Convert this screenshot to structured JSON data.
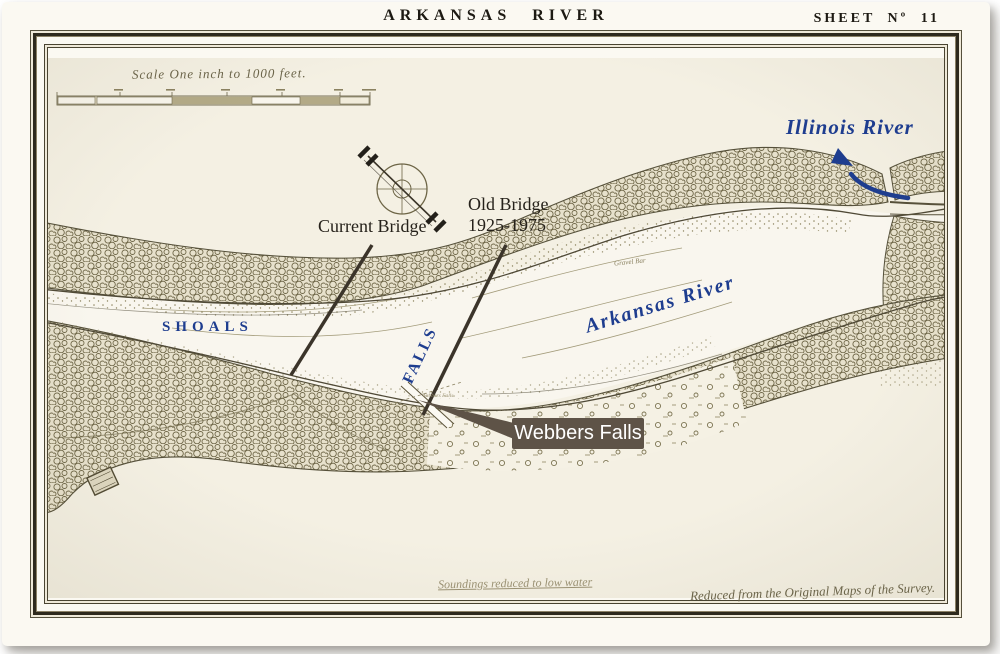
{
  "header": {
    "title": "ARKANSAS RIVER",
    "sheet_no": "SHEET Nº 11"
  },
  "scale": {
    "caption": "Scale One inch to 1000 feet."
  },
  "map_labels": {
    "shoals": "SHOALS",
    "falls": "FALLS",
    "arkansas_river": "Arkansas River",
    "illinois_river": "Illinois River",
    "gravel_bar": "Gravel Bar",
    "webbers_falls_small": "Webbers Falls"
  },
  "annotations": {
    "current_bridge": "Current Bridge",
    "old_bridge": [
      "Old Bridge",
      "1925-1975"
    ],
    "webbers_falls": "Webbers Falls"
  },
  "footnotes": {
    "soundings": "Soundings reduced to low water",
    "survey": "Reduced from the Original Maps of the Survey."
  },
  "colors": {
    "paper": "#f4f0e3",
    "map_ink": "#6d6546",
    "frame_ink": "#2e2a1d",
    "label_blue": "#1e3d8f",
    "annotation_ink": "#25211a",
    "pointer_line": "#3b342a",
    "callout_bg": "#5e5347",
    "callout_text": "#ffffff"
  }
}
